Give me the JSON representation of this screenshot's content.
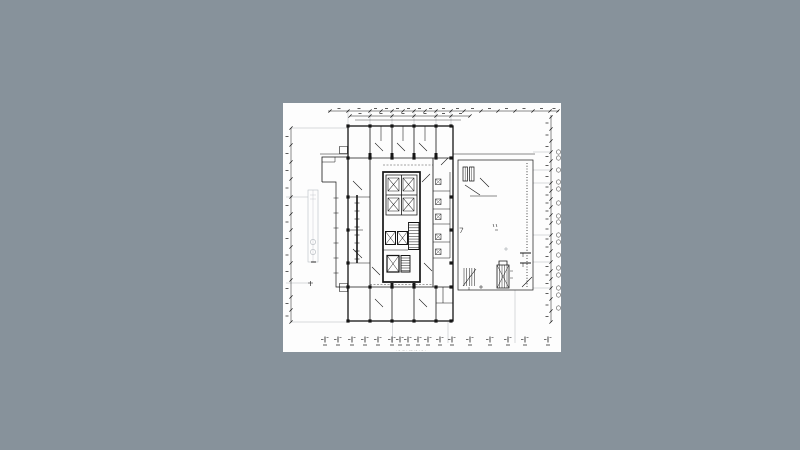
{
  "scene": {
    "bg_color": "#87929b",
    "canvas": {
      "left": 283,
      "top": 103,
      "width": 278,
      "height": 249,
      "bg": "#fdfdfd"
    }
  },
  "drawing": {
    "ink": "#161616",
    "faint": "#8f979d",
    "soft": "#b9bec3",
    "caption": "· – ·– · –– ·– · – ·",
    "columns": [
      [
        65,
        23
      ],
      [
        87,
        23
      ],
      [
        109,
        23
      ],
      [
        131,
        23
      ],
      [
        153,
        23
      ],
      [
        168,
        23
      ],
      [
        65,
        55
      ],
      [
        87,
        55
      ],
      [
        109,
        55
      ],
      [
        131,
        55
      ],
      [
        153,
        55
      ],
      [
        168,
        55
      ],
      [
        65,
        184
      ],
      [
        87,
        184
      ],
      [
        109,
        184
      ],
      [
        131,
        184
      ],
      [
        153,
        184
      ],
      [
        168,
        184
      ],
      [
        65,
        218
      ],
      [
        87,
        218
      ],
      [
        109,
        218
      ],
      [
        131,
        218
      ],
      [
        153,
        218
      ],
      [
        168,
        218
      ],
      [
        65,
        94
      ],
      [
        65,
        127
      ],
      [
        65,
        160
      ],
      [
        168,
        94
      ],
      [
        168,
        127
      ],
      [
        168,
        160
      ]
    ],
    "top_dim": {
      "y": 8,
      "x1": 45,
      "x2": 276,
      "ticks": [
        47,
        65,
        87,
        98,
        109,
        120,
        131,
        142,
        153,
        168,
        181,
        198,
        215,
        232,
        250,
        267,
        275
      ]
    },
    "top_dim2": {
      "y": 13,
      "x1": 67,
      "x2": 187,
      "ticks": [
        67,
        87,
        109,
        131,
        153,
        168,
        187
      ]
    },
    "left_dim": {
      "x": 8,
      "y1": 25,
      "y2": 219,
      "ticks": [
        25,
        42,
        59,
        76,
        94,
        111,
        127,
        144,
        160,
        177,
        194,
        207,
        219
      ]
    },
    "right_dim": {
      "x": 268,
      "y1": 12,
      "y2": 219,
      "ticks": [
        14,
        26,
        38,
        49,
        58,
        67,
        80,
        88,
        96,
        104,
        112,
        120,
        132,
        140,
        148,
        159,
        168,
        176,
        185,
        196,
        208,
        219
      ]
    },
    "bubbles": {
      "cx": 275.5,
      "r": 2.2,
      "ys": [
        49,
        55,
        67,
        79,
        86,
        100,
        113,
        119,
        132,
        139,
        152,
        165,
        172,
        185,
        192,
        205
      ]
    },
    "bottom_dim": {
      "y": 236,
      "xs": [
        42,
        55,
        69,
        82,
        95,
        109,
        117,
        125,
        135,
        145,
        157,
        169,
        187,
        207,
        225,
        242,
        265
      ]
    },
    "toilet_cells": {
      "x": 152.5,
      "w": 5.5,
      "ys": [
        76,
        96,
        111,
        131,
        146
      ]
    },
    "ladders": [
      {
        "x1": 125.5,
        "x2": 136,
        "y1": 122,
        "y2": 144.5,
        "n": 9,
        "w": 0.5
      },
      {
        "x1": 118,
        "x2": 127,
        "y1": 155,
        "y2": 167.5,
        "n": 6,
        "w": 0.5
      },
      {
        "x1": 71.5,
        "x2": 76.5,
        "y1": 100,
        "y2": 156,
        "n": 8,
        "w": 0.6
      },
      {
        "x1": 50.5,
        "x2": 55.5,
        "y1": 95,
        "y2": 170,
        "n": 6,
        "w": 0.5
      },
      {
        "x1": 181,
        "x2": 191.5,
        "y1": 165,
        "y2": 183,
        "n": 5,
        "w": 0.5,
        "vertical": true
      }
    ],
    "ext": {
      "top_xs": [
        65,
        87,
        109,
        131,
        153,
        168
      ],
      "top_y1": 7,
      "top_y2": 23,
      "bottom": [
        [
          109.5,
          219,
          240
        ],
        [
          165,
          219,
          240
        ],
        [
          232,
          187,
          240
        ]
      ],
      "left": [
        [
          8,
          65,
          25
        ],
        [
          8,
          65,
          219
        ],
        [
          3,
          25,
          94
        ],
        [
          3,
          27,
          180
        ]
      ],
      "right_ys": [
        49,
        67,
        80,
        132,
        159,
        185
      ],
      "right_x1": 250,
      "right_x2": 268
    }
  }
}
